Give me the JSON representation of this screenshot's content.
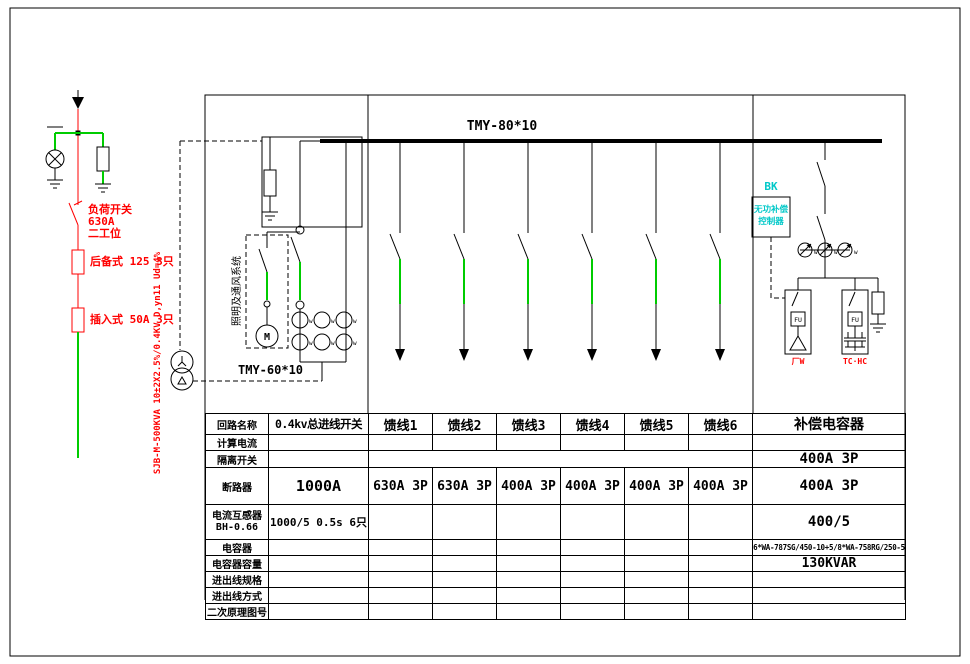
{
  "schematic": {
    "busbar_label": "TMY-80*10",
    "incoming_bus_label": "TMY-60*10",
    "ct_mark": "w",
    "left_feed": {
      "switch_name": "负荷开关",
      "switch_rating": "630A",
      "switch_type": "二工位",
      "fuse_backup": "后备式 125 3只",
      "fuse_plug": "插入式 50A 3只",
      "transformer_spec": "SJB-M-500KVA 10±2X2.5%/0.4KV D,yn11 Ud=4%"
    },
    "lighting_branch": {
      "label": "照明及通风系统",
      "motor_mark": "M"
    },
    "capacitor_bank": {
      "controller_tag": "BK",
      "controller_line1": "无功补偿",
      "controller_line2": "控制器",
      "fuse_mark": "FU",
      "delta_group_label": "厂W",
      "cap_group_label": "TC·HC"
    },
    "colors": {
      "line_red": "#ff0000",
      "line_green": "#00cc00",
      "label_cyan": "#00c8c8"
    }
  },
  "table": {
    "row_labels": {
      "circuit_name": "回路名称",
      "calc_current": "计算电流",
      "isolator": "隔离开关",
      "breaker": "断路器",
      "ct_line1": "电流互感器",
      "ct_line2": "BH-0.66",
      "capacitor": "电容器",
      "capacitor_capacity": "电容器容量",
      "inout_spec": "进出线规格",
      "inout_mode": "进出线方式",
      "secondary_diagram": "二次原理图号"
    },
    "columns": [
      "0.4kv总进线开关",
      "馈线1",
      "馈线2",
      "馈线3",
      "馈线4",
      "馈线5",
      "馈线6",
      "补偿电容器"
    ],
    "isolator": {
      "cap": "400A 3P"
    },
    "breaker": [
      "1000A",
      "630A 3P",
      "630A 3P",
      "400A 3P",
      "400A 3P",
      "400A 3P",
      "400A 3P",
      "400A 3P"
    ],
    "ct": {
      "main": "1000/5 0.5s 6只",
      "cap": "400/5"
    },
    "capacitor": {
      "model": "6*WA-787SG/450-10+5/8*WA-758RG/250-5",
      "capacity": "130KVAR"
    }
  }
}
